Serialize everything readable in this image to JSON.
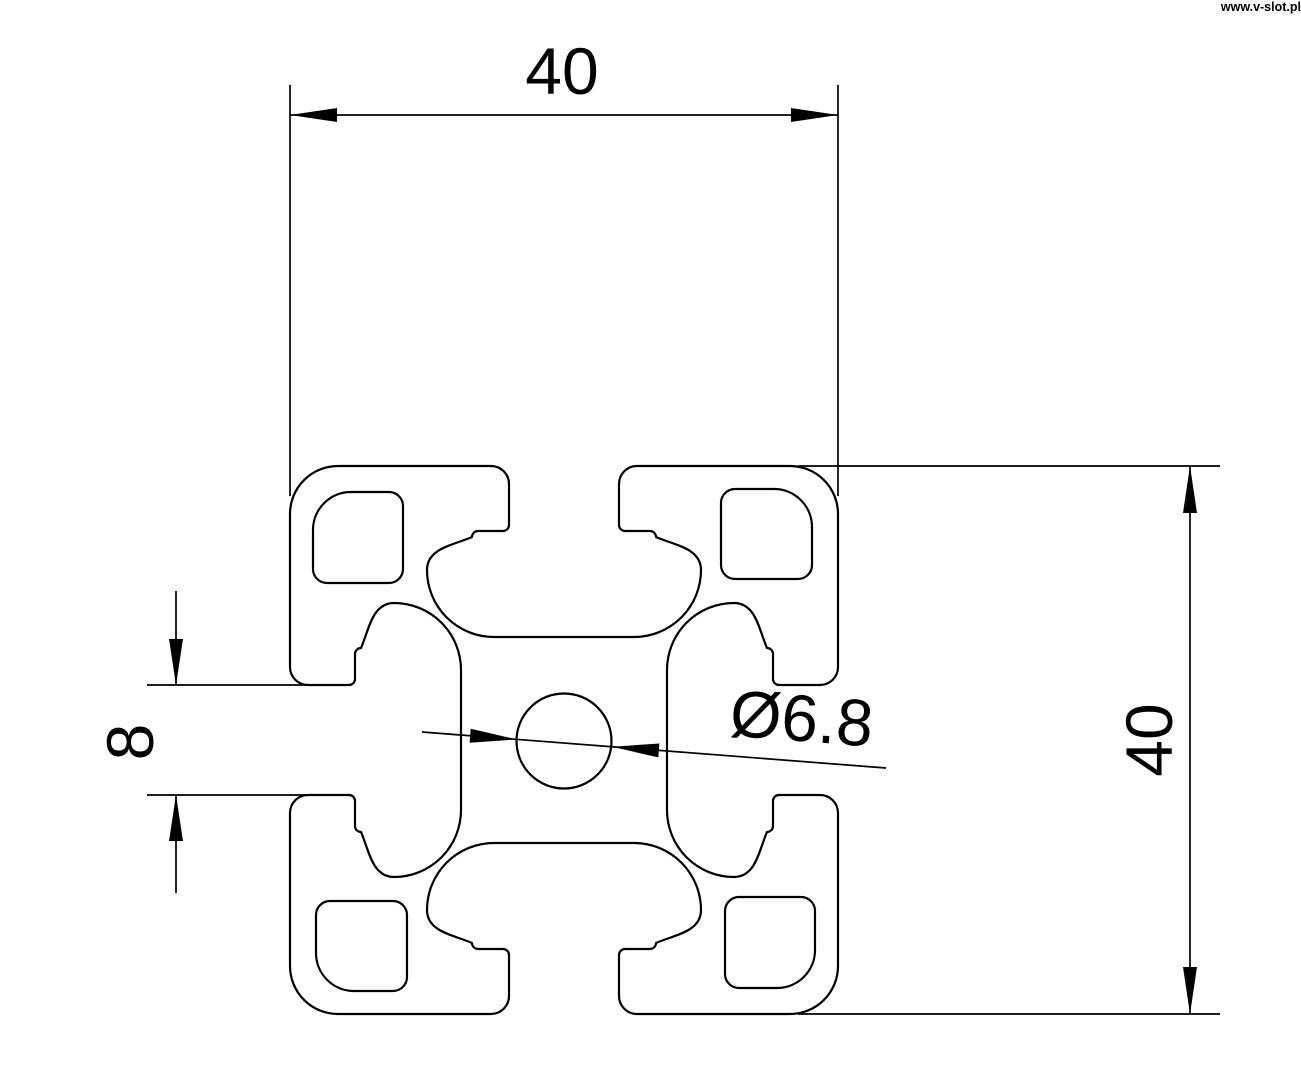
{
  "watermark": {
    "text": "www.v-slot.pl",
    "color": "#000000"
  },
  "drawing": {
    "subject": "aluminium-profile-cross-section",
    "colors": {
      "background": "#ffffff",
      "line": "#000000"
    },
    "dimensions": {
      "overall_width": {
        "label": "40"
      },
      "overall_height": {
        "label": "40"
      },
      "slot_opening": {
        "label": "8"
      },
      "center_hole": {
        "label": "Ø6.8"
      }
    }
  }
}
